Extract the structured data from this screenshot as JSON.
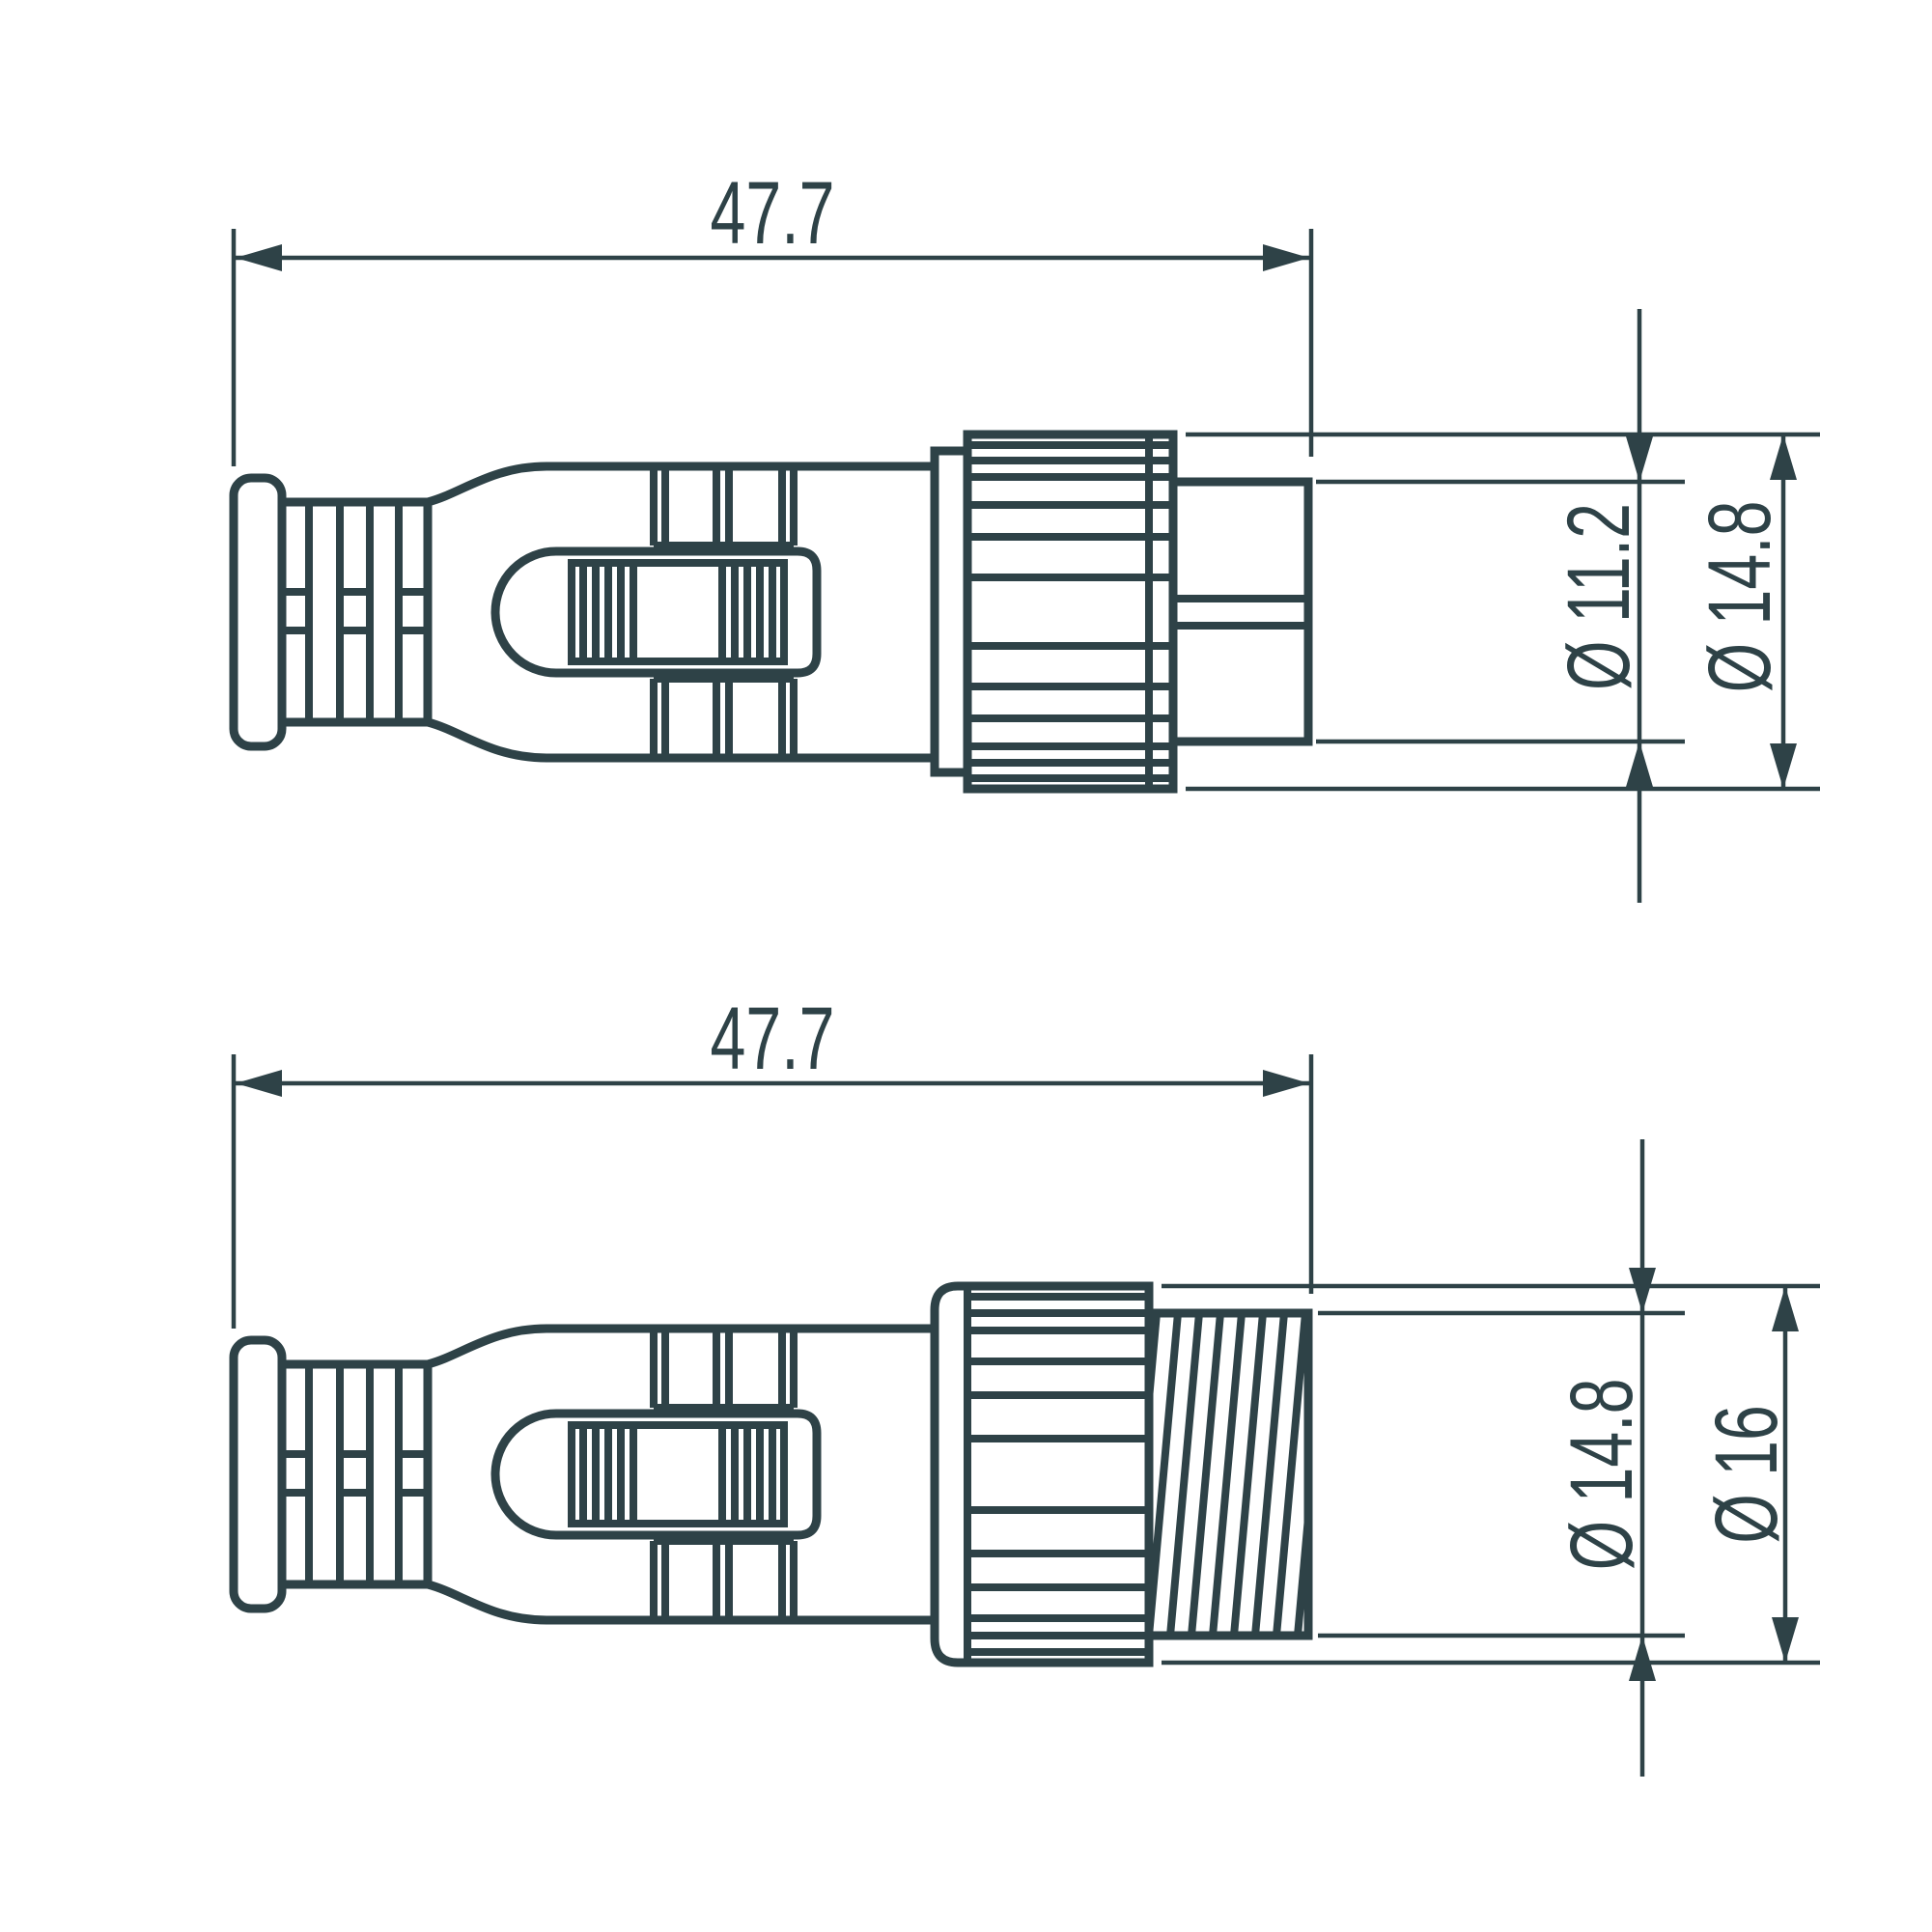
{
  "colors": {
    "background": "#ffffff",
    "line": "#2e4247"
  },
  "views": {
    "male": {
      "length": "47.7",
      "pin_diameter": "Ø 11.2",
      "nut_diameter": "Ø 14.8"
    },
    "female": {
      "length": "47.7",
      "thread_diameter": "Ø 14.8",
      "nut_diameter": "Ø 16"
    }
  }
}
